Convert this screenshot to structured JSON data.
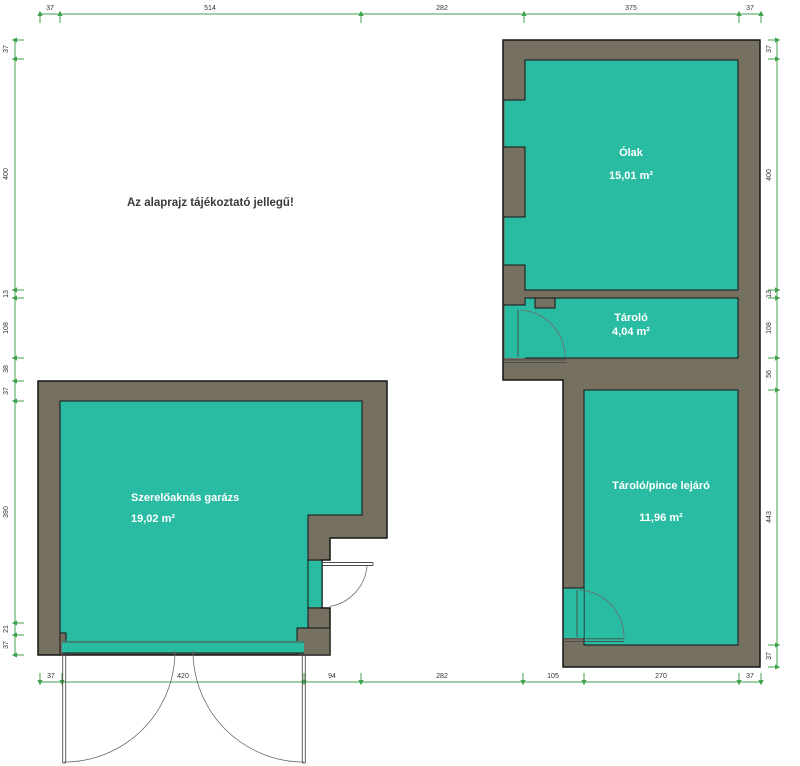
{
  "note": "Az alaprajz tájékoztató jellegű!",
  "rooms": {
    "olak": {
      "name": "Ólak",
      "area": "15,01 m²"
    },
    "tarolo": {
      "name": "Tároló",
      "area": "4,04 m²"
    },
    "pince": {
      "name": "Tároló/pince lejáró",
      "area": "11,96 m²"
    },
    "garazs": {
      "name": "Szerelőaknás garázs",
      "area": "19,02 m²"
    }
  },
  "dims": {
    "top": [
      "37",
      "514",
      "282",
      "375",
      "37"
    ],
    "bottom": [
      "37",
      "420",
      "94",
      "282",
      "105",
      "270",
      "37"
    ],
    "left": [
      "37",
      "400",
      "13",
      "108",
      "38",
      "37",
      "390",
      "21",
      "37"
    ],
    "right": [
      "37",
      "400",
      "13",
      "108",
      "56",
      "443",
      "37"
    ]
  },
  "colors": {
    "room_fill": "#2abca2",
    "wall_fill": "#75705f",
    "outline": "#141414",
    "dim_green": "#3fa24c",
    "door_line": "#4a4a4a"
  }
}
